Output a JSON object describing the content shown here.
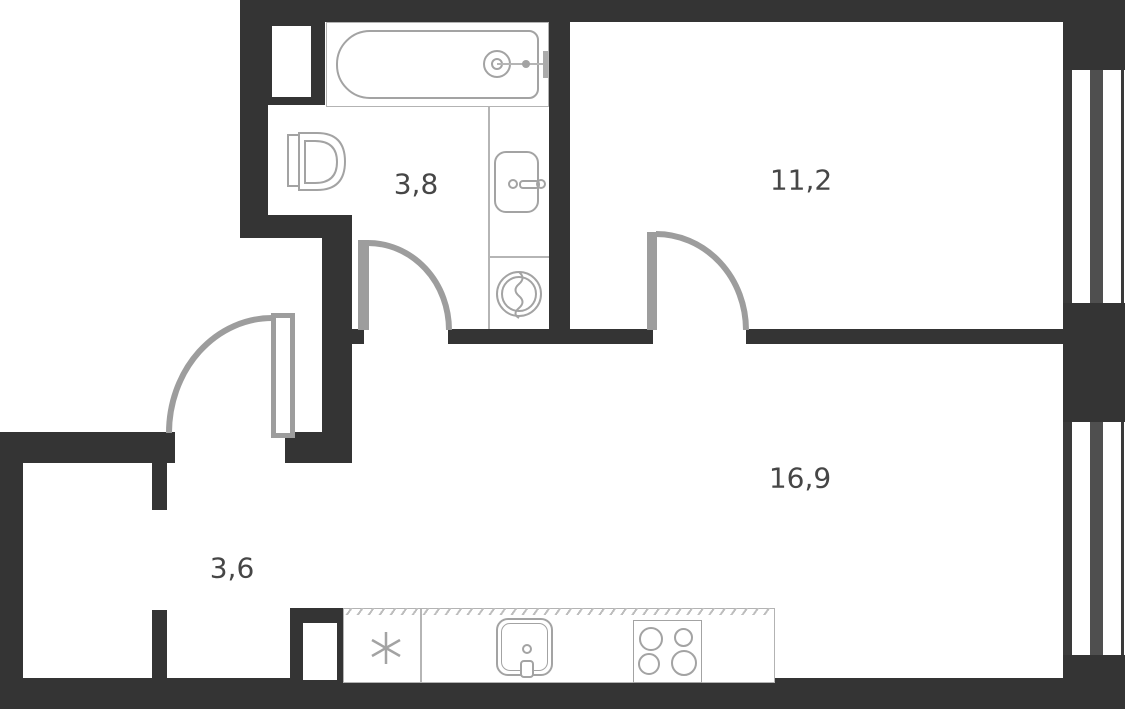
{
  "floor_plan": {
    "kind": "apartment-floor-plan-one-bedroom",
    "rooms": {
      "bathroom": {
        "name": "bathroom",
        "area_label": "3,8"
      },
      "bedroom": {
        "name": "bedroom",
        "area_label": "11,2"
      },
      "kitchen_living": {
        "name": "kitchen-living-room",
        "area_label": "16,9"
      },
      "hallway": {
        "name": "hallway",
        "area_label": "3,6"
      }
    },
    "fixtures": {
      "bathtub": "bathtub with faucet",
      "toilet": "toilet",
      "bathroom_sink": "bathroom sink with tap",
      "washing_machine": "washing machine",
      "kitchen_counter": "kitchen counter",
      "fridge_symbol": "snowflake fridge symbol",
      "kitchen_sink": "kitchen sink with tap",
      "stove": "four-burner stove"
    },
    "doors": [
      "entry-door",
      "bathroom-door",
      "bedroom-door"
    ],
    "windows": [
      "bedroom-window",
      "living-room-window"
    ],
    "colors": {
      "wall": "#343434",
      "window_mullion": "#4f4f4f",
      "fixture_line": "#a3a3a3",
      "door": "#9d9d9d",
      "label_text": "#464646",
      "background": "#ffffff"
    }
  }
}
